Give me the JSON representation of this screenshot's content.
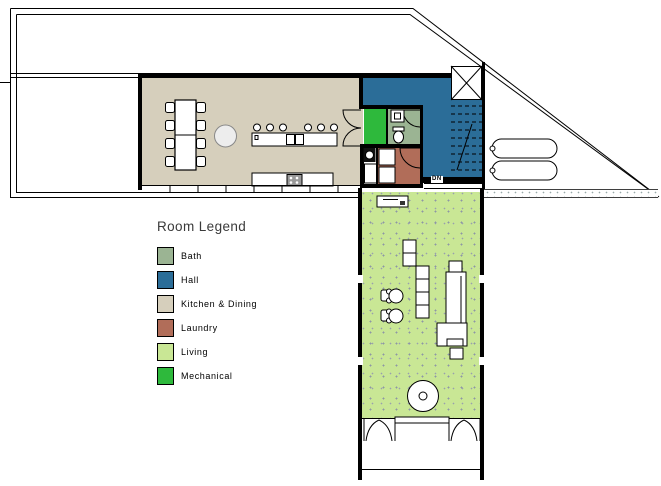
{
  "plan": {
    "stair_label": "DN",
    "rooms": {
      "bath": {
        "name": "Bath",
        "color": "#9bb493"
      },
      "hall": {
        "name": "Hall",
        "color": "#2b6d98"
      },
      "kitchen_dining": {
        "name": "Kitchen & Dining",
        "color": "#d6cfbc"
      },
      "laundry": {
        "name": "Laundry",
        "color": "#b16d59"
      },
      "living": {
        "name": "Living",
        "color": "#c9e795"
      },
      "mechanical": {
        "name": "Mechanical",
        "color": "#2eb93c"
      }
    }
  },
  "legend": {
    "title": "Room Legend",
    "items": [
      {
        "label": "Bath",
        "color": "#9bb493"
      },
      {
        "label": "Hall",
        "color": "#2b6d98"
      },
      {
        "label": "Kitchen & Dining",
        "color": "#d6cfbc"
      },
      {
        "label": "Laundry",
        "color": "#b16d59"
      },
      {
        "label": "Living",
        "color": "#c9e795"
      },
      {
        "label": "Mechanical",
        "color": "#2eb93c"
      }
    ]
  }
}
